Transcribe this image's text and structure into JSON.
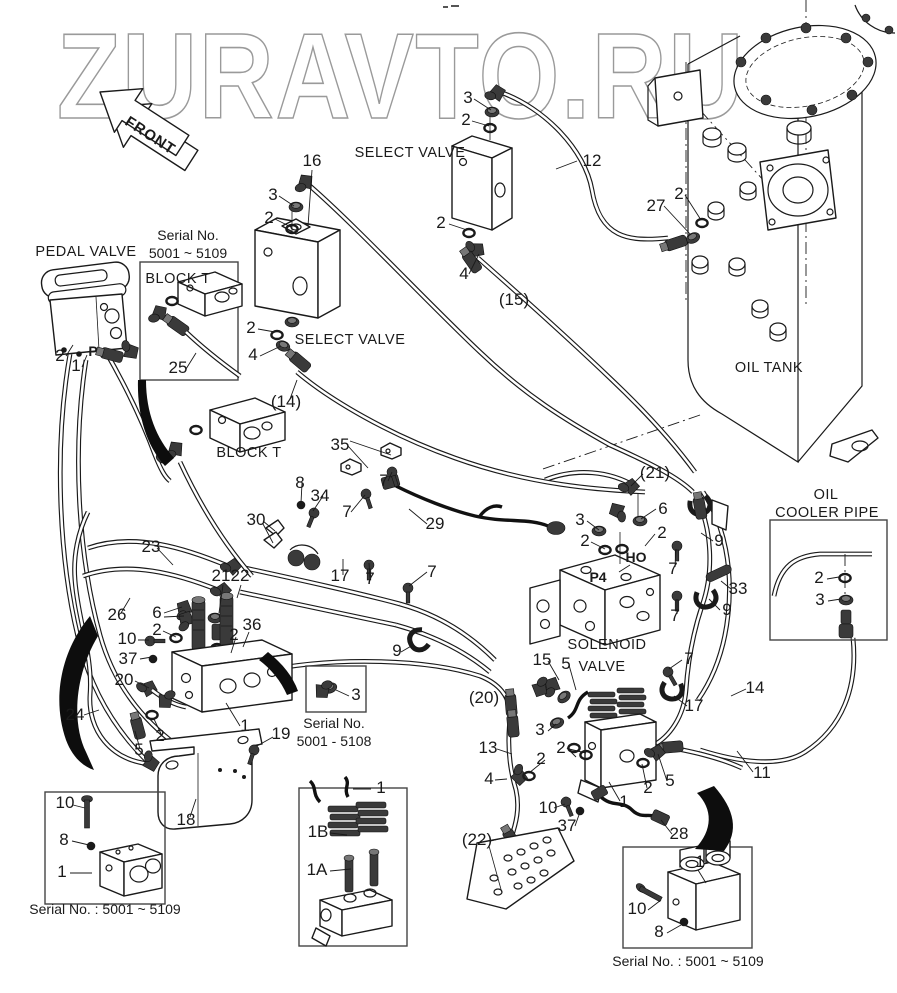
{
  "watermark": {
    "text": "ZURAVTO.RU",
    "outline_color": "#9a9a9a"
  },
  "front_arrow": {
    "label": "FRONT"
  },
  "colors": {
    "line": "#1a1a1a",
    "background": "#ffffff"
  },
  "component_labels": [
    {
      "text": "SELECT VALVE",
      "x": 410,
      "y": 157,
      "cls": "comp"
    },
    {
      "text": "SELECT VALVE",
      "x": 350,
      "y": 344,
      "cls": "comp"
    },
    {
      "text": "PEDAL VALVE",
      "x": 86,
      "y": 256,
      "cls": "comp"
    },
    {
      "text": "BLOCK T",
      "x": 178,
      "y": 283,
      "cls": "comp"
    },
    {
      "text": "BLOCK T",
      "x": 249,
      "y": 457,
      "cls": "comp"
    },
    {
      "text": "OIL TANK",
      "x": 769,
      "y": 372,
      "cls": "comp"
    },
    {
      "text": "SOLENOID",
      "x": 607,
      "y": 649,
      "cls": "comp"
    },
    {
      "text": "VALVE",
      "x": 602,
      "y": 671,
      "cls": "comp"
    },
    {
      "text": "OIL",
      "x": 826,
      "y": 499,
      "cls": "comp"
    },
    {
      "text": "COOLER PIPE",
      "x": 827,
      "y": 517,
      "cls": "comp"
    }
  ],
  "serial_notes": [
    {
      "text": "Serial No.",
      "x": 188,
      "y": 240,
      "cls": "serial"
    },
    {
      "text": "5001 ~ 5109",
      "x": 188,
      "y": 258,
      "cls": "serial"
    },
    {
      "text": "Serial No.",
      "x": 334,
      "y": 728,
      "cls": "serial"
    },
    {
      "text": "5001 - 5108",
      "x": 334,
      "y": 746,
      "cls": "serial"
    },
    {
      "text": "Serial No. : 5001 ~ 5109",
      "x": 105,
      "y": 914,
      "cls": "serial"
    },
    {
      "text": "Serial No. : 5001 ~ 5109",
      "x": 688,
      "y": 966,
      "cls": "serial"
    }
  ],
  "port_labels": [
    {
      "text": "P",
      "x": 93,
      "y": 356,
      "cls": "port"
    },
    {
      "text": "HO",
      "x": 636,
      "y": 562,
      "cls": "port"
    },
    {
      "text": "P4",
      "x": 598,
      "y": 582,
      "cls": "port"
    }
  ],
  "part_numbers": [
    {
      "text": "16",
      "x": 312,
      "y": 166
    },
    {
      "text": "3",
      "x": 273,
      "y": 200
    },
    {
      "text": "2",
      "x": 269,
      "y": 223
    },
    {
      "text": "3",
      "x": 468,
      "y": 103
    },
    {
      "text": "2",
      "x": 466,
      "y": 125
    },
    {
      "text": "12",
      "x": 592,
      "y": 166
    },
    {
      "text": "2",
      "x": 441,
      "y": 228
    },
    {
      "text": "4",
      "x": 464,
      "y": 279
    },
    {
      "text": "27",
      "x": 656,
      "y": 211
    },
    {
      "text": "2",
      "x": 679,
      "y": 199
    },
    {
      "text": "(15)",
      "x": 514,
      "y": 305
    },
    {
      "text": "2",
      "x": 251,
      "y": 333
    },
    {
      "text": "4",
      "x": 253,
      "y": 360
    },
    {
      "text": "(14)",
      "x": 286,
      "y": 407
    },
    {
      "text": "25",
      "x": 178,
      "y": 373
    },
    {
      "text": "2",
      "x": 60,
      "y": 361
    },
    {
      "text": "1",
      "x": 76,
      "y": 371
    },
    {
      "text": "35",
      "x": 340,
      "y": 450
    },
    {
      "text": "7",
      "x": 384,
      "y": 486
    },
    {
      "text": "8",
      "x": 300,
      "y": 488
    },
    {
      "text": "34",
      "x": 320,
      "y": 501
    },
    {
      "text": "30",
      "x": 256,
      "y": 525
    },
    {
      "text": "7",
      "x": 347,
      "y": 517
    },
    {
      "text": "29",
      "x": 435,
      "y": 529
    },
    {
      "text": "17",
      "x": 340,
      "y": 581
    },
    {
      "text": "7",
      "x": 370,
      "y": 584
    },
    {
      "text": "7",
      "x": 432,
      "y": 577
    },
    {
      "text": "(21)",
      "x": 655,
      "y": 478
    },
    {
      "text": "6",
      "x": 663,
      "y": 514
    },
    {
      "text": "3",
      "x": 580,
      "y": 525
    },
    {
      "text": "2",
      "x": 585,
      "y": 546
    },
    {
      "text": "2",
      "x": 662,
      "y": 538
    },
    {
      "text": "9",
      "x": 719,
      "y": 546
    },
    {
      "text": "7",
      "x": 673,
      "y": 574
    },
    {
      "text": "33",
      "x": 738,
      "y": 594
    },
    {
      "text": "9",
      "x": 727,
      "y": 615
    },
    {
      "text": "7",
      "x": 675,
      "y": 621
    },
    {
      "text": "23",
      "x": 151,
      "y": 552
    },
    {
      "text": "26",
      "x": 117,
      "y": 620
    },
    {
      "text": "21",
      "x": 221,
      "y": 581
    },
    {
      "text": "22",
      "x": 240,
      "y": 581
    },
    {
      "text": "6",
      "x": 157,
      "y": 618
    },
    {
      "text": "2",
      "x": 157,
      "y": 635
    },
    {
      "text": "10",
      "x": 127,
      "y": 644
    },
    {
      "text": "37",
      "x": 128,
      "y": 664
    },
    {
      "text": "36",
      "x": 252,
      "y": 630
    },
    {
      "text": "2",
      "x": 234,
      "y": 640
    },
    {
      "text": "20",
      "x": 124,
      "y": 685
    },
    {
      "text": "24",
      "x": 75,
      "y": 720
    },
    {
      "text": "1",
      "x": 245,
      "y": 731
    },
    {
      "text": "2",
      "x": 160,
      "y": 741
    },
    {
      "text": "5",
      "x": 139,
      "y": 755
    },
    {
      "text": "19",
      "x": 281,
      "y": 739
    },
    {
      "text": "18",
      "x": 186,
      "y": 825
    },
    {
      "text": "3",
      "x": 356,
      "y": 700
    },
    {
      "text": "9",
      "x": 397,
      "y": 656
    },
    {
      "text": "10",
      "x": 65,
      "y": 808
    },
    {
      "text": "8",
      "x": 64,
      "y": 845
    },
    {
      "text": "1",
      "x": 62,
      "y": 877
    },
    {
      "text": "1",
      "x": 381,
      "y": 793
    },
    {
      "text": "1B",
      "x": 318,
      "y": 837
    },
    {
      "text": "1A",
      "x": 317,
      "y": 875
    },
    {
      "text": "(20)",
      "x": 484,
      "y": 703
    },
    {
      "text": "13",
      "x": 488,
      "y": 753
    },
    {
      "text": "4",
      "x": 489,
      "y": 784
    },
    {
      "text": "2",
      "x": 541,
      "y": 764
    },
    {
      "text": "3",
      "x": 540,
      "y": 735
    },
    {
      "text": "2",
      "x": 561,
      "y": 753
    },
    {
      "text": "10",
      "x": 548,
      "y": 813
    },
    {
      "text": "37",
      "x": 567,
      "y": 831
    },
    {
      "text": "(22)",
      "x": 477,
      "y": 845
    },
    {
      "text": "15",
      "x": 542,
      "y": 665
    },
    {
      "text": "5",
      "x": 566,
      "y": 669
    },
    {
      "text": "7",
      "x": 689,
      "y": 664
    },
    {
      "text": "14",
      "x": 755,
      "y": 693
    },
    {
      "text": "17",
      "x": 694,
      "y": 711
    },
    {
      "text": "11",
      "x": 762,
      "y": 778
    },
    {
      "text": "1",
      "x": 624,
      "y": 807
    },
    {
      "text": "2",
      "x": 648,
      "y": 793
    },
    {
      "text": "5",
      "x": 670,
      "y": 786
    },
    {
      "text": "28",
      "x": 679,
      "y": 839
    },
    {
      "text": "1",
      "x": 700,
      "y": 867
    },
    {
      "text": "10",
      "x": 637,
      "y": 914
    },
    {
      "text": "8",
      "x": 659,
      "y": 937
    },
    {
      "text": "2",
      "x": 819,
      "y": 583
    },
    {
      "text": "3",
      "x": 820,
      "y": 605
    }
  ]
}
